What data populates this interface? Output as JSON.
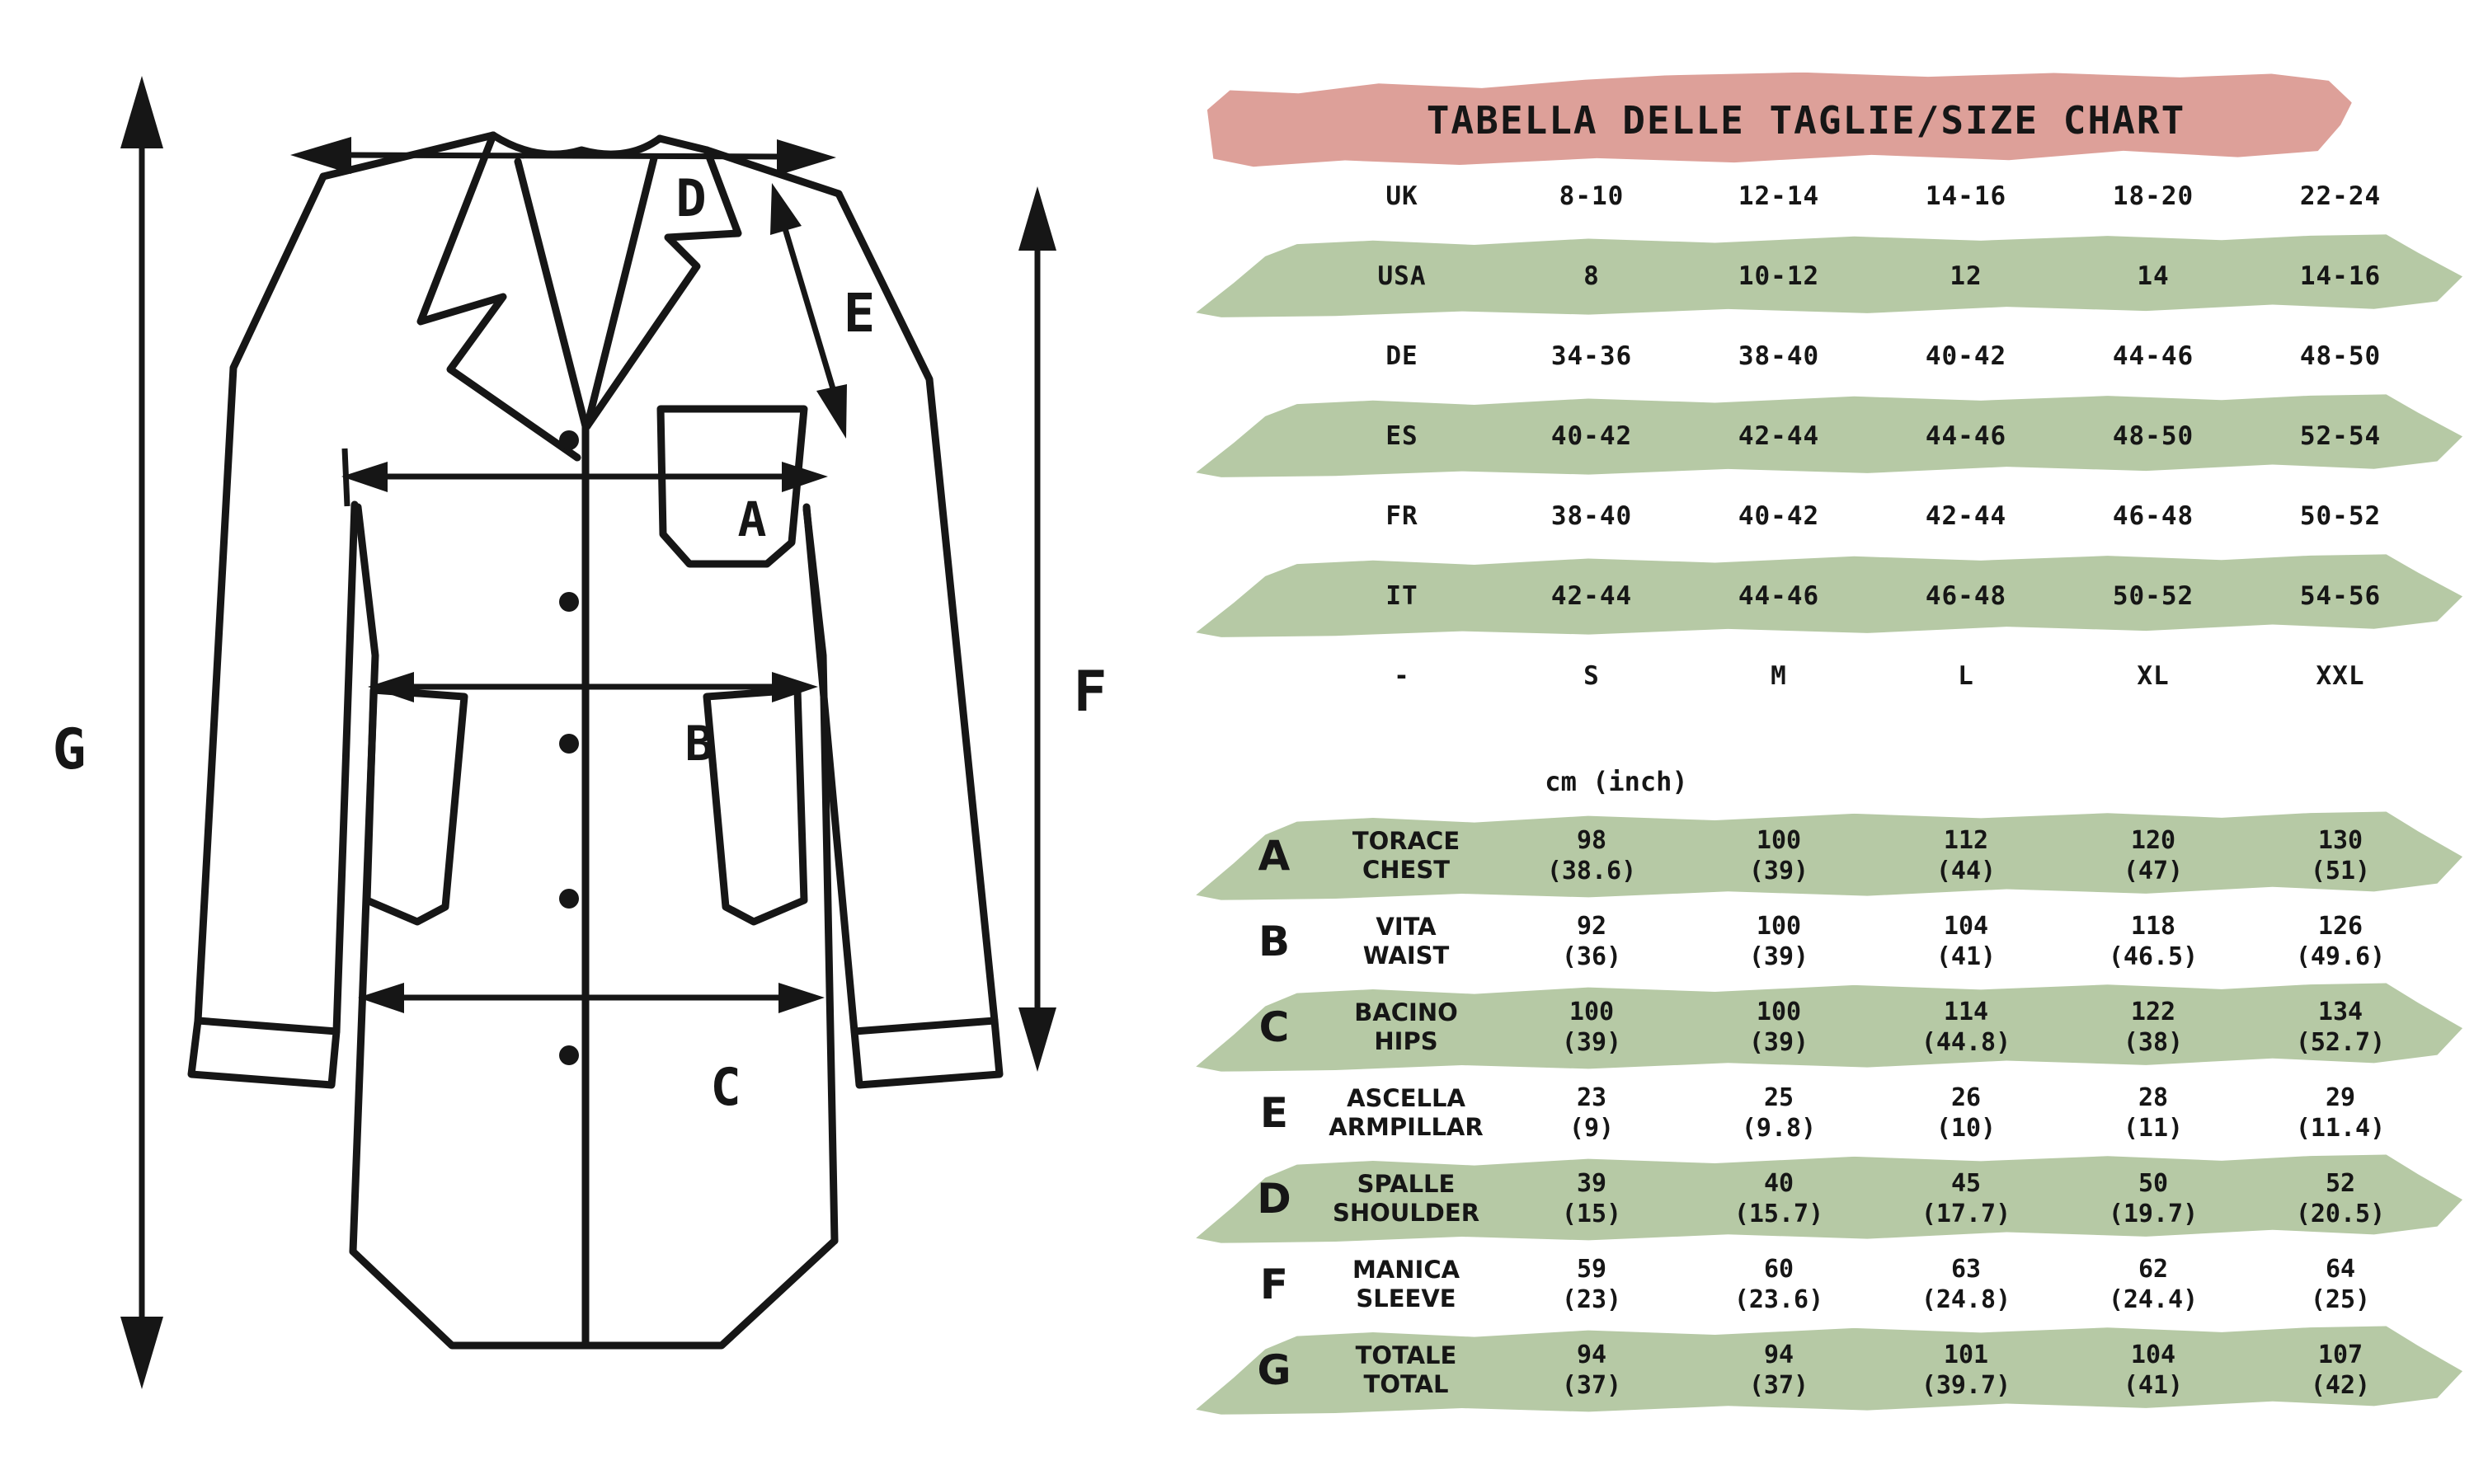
{
  "title": "TABELLA DELLE TAGLIE/SIZE CHART",
  "units_header": "cm (inch)",
  "colors": {
    "highlight_pink": "#dda099",
    "highlight_green": "#b6c9a5",
    "ink": "#161616"
  },
  "diagram": {
    "description": "lab coat measurement sketch",
    "labels": {
      "A": "A",
      "B": "B",
      "C": "C",
      "D": "D",
      "E": "E",
      "F": "F",
      "G": "G"
    }
  },
  "conversion_table": {
    "rows": [
      {
        "region": "UK",
        "values": [
          "8-10",
          "12-14",
          "14-16",
          "18-20",
          "22-24"
        ],
        "band": false
      },
      {
        "region": "USA",
        "values": [
          "8",
          "10-12",
          "12",
          "14",
          "14-16"
        ],
        "band": true
      },
      {
        "region": "DE",
        "values": [
          "34-36",
          "38-40",
          "40-42",
          "44-46",
          "48-50"
        ],
        "band": false
      },
      {
        "region": "ES",
        "values": [
          "40-42",
          "42-44",
          "44-46",
          "48-50",
          "52-54"
        ],
        "band": true
      },
      {
        "region": "FR",
        "values": [
          "38-40",
          "40-42",
          "42-44",
          "46-48",
          "50-52"
        ],
        "band": false
      },
      {
        "region": "IT",
        "values": [
          "42-44",
          "44-46",
          "46-48",
          "50-52",
          "54-56"
        ],
        "band": true
      },
      {
        "region": "-",
        "values": [
          "S",
          "M",
          "L",
          "XL",
          "XXL"
        ],
        "band": false
      }
    ]
  },
  "measurement_table": {
    "rows": [
      {
        "letter": "A",
        "name_it": "TORACE",
        "name_en": "CHEST",
        "cm": [
          "98",
          "100",
          "112",
          "120",
          "130"
        ],
        "inch": [
          "(38.6)",
          "(39)",
          "(44)",
          "(47)",
          "(51)"
        ],
        "band": true
      },
      {
        "letter": "B",
        "name_it": "VITA",
        "name_en": "WAIST",
        "cm": [
          "92",
          "100",
          "104",
          "118",
          "126"
        ],
        "inch": [
          "(36)",
          "(39)",
          "(41)",
          "(46.5)",
          "(49.6)"
        ],
        "band": false
      },
      {
        "letter": "C",
        "name_it": "BACINO",
        "name_en": "HIPS",
        "cm": [
          "100",
          "100",
          "114",
          "122",
          "134"
        ],
        "inch": [
          "(39)",
          "(39)",
          "(44.8)",
          "(38)",
          "(52.7)"
        ],
        "band": true
      },
      {
        "letter": "E",
        "name_it": "ASCELLA",
        "name_en": "ARMPILLAR",
        "cm": [
          "23",
          "25",
          "26",
          "28",
          "29"
        ],
        "inch": [
          "(9)",
          "(9.8)",
          "(10)",
          "(11)",
          "(11.4)"
        ],
        "band": false
      },
      {
        "letter": "D",
        "name_it": "SPALLE",
        "name_en": "SHOULDER",
        "cm": [
          "39",
          "40",
          "45",
          "50",
          "52"
        ],
        "inch": [
          "(15)",
          "(15.7)",
          "(17.7)",
          "(19.7)",
          "(20.5)"
        ],
        "band": true
      },
      {
        "letter": "F",
        "name_it": "MANICA",
        "name_en": "SLEEVE",
        "cm": [
          "59",
          "60",
          "63",
          "62",
          "64"
        ],
        "inch": [
          "(23)",
          "(23.6)",
          "(24.8)",
          "(24.4)",
          "(25)"
        ],
        "band": false
      },
      {
        "letter": "G",
        "name_it": "TOTALE",
        "name_en": "TOTAL",
        "cm": [
          "94",
          "94",
          "101",
          "104",
          "107"
        ],
        "inch": [
          "(37)",
          "(37)",
          "(39.7)",
          "(41)",
          "(42)"
        ],
        "band": true
      }
    ]
  }
}
